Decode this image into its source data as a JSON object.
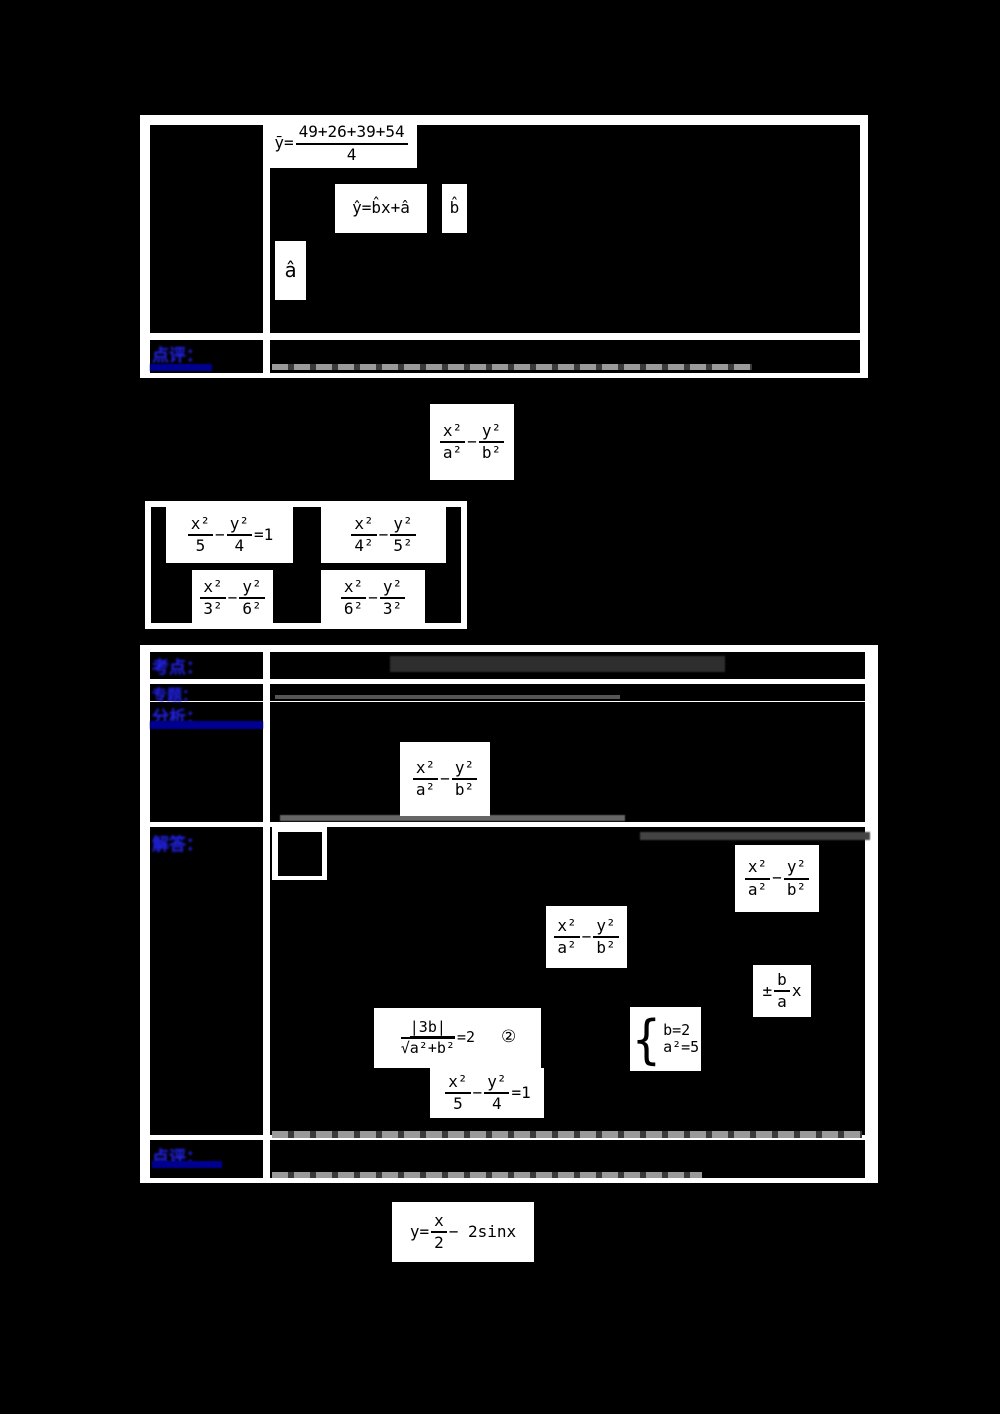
{
  "colors": {
    "page_bg": "#000000",
    "table_bg": "#ffffff",
    "cell_bg": "#000000",
    "label_blue": "#2222ee",
    "underline_navy": "#000090",
    "formula_ink": "#000000"
  },
  "glyphs": {
    "minus": "−",
    "plus_minus": "±",
    "radical": "√",
    "circled_two": "②"
  },
  "table1": {
    "review_label": "点评：",
    "mean_formula": {
      "lhs": "ȳ=",
      "num": "49+26+39+54",
      "den": "4"
    },
    "regression_formula": "ŷ=b̂x+â",
    "b_hat": "b̂",
    "a_hat": "â"
  },
  "problem": {
    "general_hyperbola": {
      "num1": "x²",
      "den1": "a²",
      "num2": "y²",
      "den2": "b²",
      "suffix": ""
    },
    "options": {
      "a": {
        "num1": "x²",
        "den1": "5",
        "num2": "y²",
        "den2": "4",
        "suffix": "=1"
      },
      "b": {
        "num1": "x²",
        "den1": "4²",
        "num2": "y²",
        "den2": "5²",
        "suffix": ""
      },
      "c": {
        "num1": "x²",
        "den1": "3²",
        "num2": "y²",
        "den2": "6²",
        "suffix": ""
      },
      "d": {
        "num1": "x²",
        "den1": "6²",
        "num2": "y²",
        "den2": "3²",
        "suffix": ""
      }
    }
  },
  "table2": {
    "labels": {
      "kaodian": "考点：",
      "zhuanti": "专题：",
      "fenxi": "分析：",
      "jieda": "解答：",
      "dianping": "点评："
    },
    "analysis_formula": {
      "num1": "x²",
      "den1": "a²",
      "num2": "y²",
      "den2": "b²",
      "suffix": ""
    },
    "solution": {
      "hyperbola1": {
        "num1": "x²",
        "den1": "a²",
        "num2": "y²",
        "den2": "b²",
        "suffix": ""
      },
      "hyperbola2": {
        "num1": "x²",
        "den1": "a²",
        "num2": "y²",
        "den2": "b²",
        "suffix": ""
      },
      "asymptote": {
        "pm": "±",
        "num": "b",
        "den": "a",
        "suffix": "x"
      },
      "distance": {
        "num": "|3b|",
        "radical": "√",
        "radicand": "a²+b²",
        "suffix": "=2",
        "tag": "②"
      },
      "system": {
        "line1": "b=2",
        "line2": "a²=5"
      },
      "result": {
        "num1": "x²",
        "den1": "5",
        "num2": "y²",
        "den2": "4",
        "suffix": "=1"
      }
    }
  },
  "footer_formula": {
    "lhs": "y=",
    "num": "x",
    "den": "2",
    "rhs": "− 2sinx"
  }
}
